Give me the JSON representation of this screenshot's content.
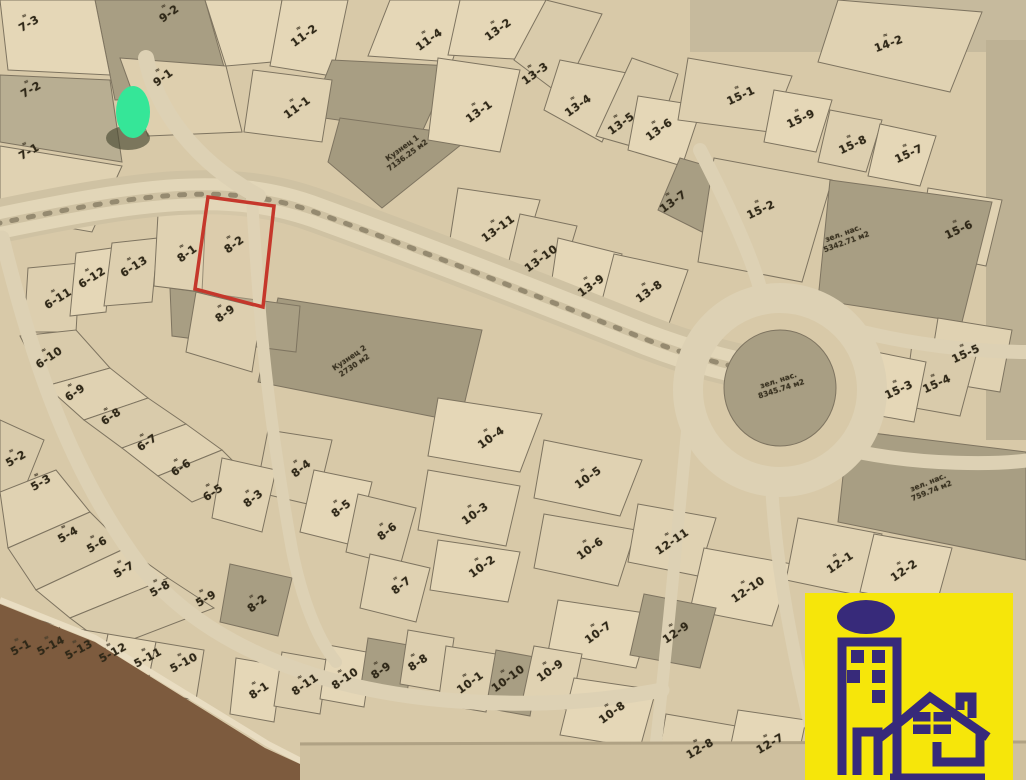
{
  "map": {
    "type": "cadastral-plot-plan-photo",
    "marker": {
      "name": "green-location-dot",
      "x": 133,
      "y": 113
    },
    "highlighted_plot": {
      "id": "8-2",
      "outline_color": "#c5372b"
    },
    "colors": {
      "paper": "#d8c9a8",
      "parcel_light": "#e5d7b7",
      "parcel_dark": "#a89e83",
      "road": "#dcd0b2",
      "line": "#7e7460",
      "red_outline": "#c5372b",
      "green_dot": "#35e698",
      "logo_bg": "#f6e60a",
      "logo_fg": "#372a7a",
      "table_corner": "#7d5b3e"
    },
    "plot_labels": [
      {
        "t": "7-3",
        "x": 28,
        "y": 22,
        "r": -30
      },
      {
        "t": "7-2",
        "x": 30,
        "y": 88,
        "r": -30
      },
      {
        "t": "7-1",
        "x": 28,
        "y": 150,
        "r": -30
      },
      {
        "t": "9-2",
        "x": 168,
        "y": 12,
        "r": -36
      },
      {
        "t": "9-1",
        "x": 162,
        "y": 76,
        "r": -36
      },
      {
        "t": "11-2",
        "x": 303,
        "y": 34,
        "r": -36
      },
      {
        "t": "11-4",
        "x": 428,
        "y": 38,
        "r": -36
      },
      {
        "t": "11-1",
        "x": 296,
        "y": 106,
        "r": -36
      },
      {
        "t": "13-2",
        "x": 497,
        "y": 28,
        "r": -36
      },
      {
        "t": "13-3",
        "x": 534,
        "y": 72,
        "r": -36
      },
      {
        "t": "13-1",
        "x": 478,
        "y": 110,
        "r": -36
      },
      {
        "t": "13-4",
        "x": 577,
        "y": 104,
        "r": -36
      },
      {
        "t": "13-5",
        "x": 620,
        "y": 122,
        "r": -36
      },
      {
        "t": "13-6",
        "x": 658,
        "y": 128,
        "r": -36
      },
      {
        "t": "13-7",
        "x": 672,
        "y": 200,
        "r": -36
      },
      {
        "t": "14-2",
        "x": 888,
        "y": 42,
        "r": -20
      },
      {
        "t": "15-1",
        "x": 740,
        "y": 94,
        "r": -25
      },
      {
        "t": "15-9",
        "x": 800,
        "y": 117,
        "r": -25
      },
      {
        "t": "15-8",
        "x": 852,
        "y": 143,
        "r": -25
      },
      {
        "t": "15-7",
        "x": 908,
        "y": 152,
        "r": -25
      },
      {
        "t": "15-2",
        "x": 760,
        "y": 208,
        "r": -25
      },
      {
        "t": "15-6",
        "x": 958,
        "y": 228,
        "r": -25
      },
      {
        "t": "15-5",
        "x": 965,
        "y": 352,
        "r": -25
      },
      {
        "t": "15-4",
        "x": 936,
        "y": 382,
        "r": -25
      },
      {
        "t": "15-3",
        "x": 898,
        "y": 388,
        "r": -25
      },
      {
        "t": "13-11",
        "x": 497,
        "y": 227,
        "r": -36
      },
      {
        "t": "13-10",
        "x": 540,
        "y": 257,
        "r": -36
      },
      {
        "t": "13-9",
        "x": 590,
        "y": 284,
        "r": -36
      },
      {
        "t": "13-8",
        "x": 648,
        "y": 290,
        "r": -36
      },
      {
        "t": "6-11",
        "x": 57,
        "y": 297,
        "r": -32
      },
      {
        "t": "6-12",
        "x": 91,
        "y": 276,
        "r": -32
      },
      {
        "t": "6-13",
        "x": 133,
        "y": 265,
        "r": -32
      },
      {
        "t": "8-1",
        "x": 186,
        "y": 252,
        "r": -36
      },
      {
        "t": "8-2",
        "x": 233,
        "y": 243,
        "r": -36
      },
      {
        "t": "8-9",
        "x": 224,
        "y": 312,
        "r": -36
      },
      {
        "t": "6-10",
        "x": 48,
        "y": 356,
        "r": -34
      },
      {
        "t": "6-9",
        "x": 74,
        "y": 391,
        "r": -34
      },
      {
        "t": "6-8",
        "x": 110,
        "y": 415,
        "r": -34
      },
      {
        "t": "6-7",
        "x": 146,
        "y": 441,
        "r": -34
      },
      {
        "t": "6-6",
        "x": 180,
        "y": 466,
        "r": -34
      },
      {
        "t": "6-5",
        "x": 212,
        "y": 491,
        "r": -34
      },
      {
        "t": "5-2",
        "x": 15,
        "y": 457,
        "r": -30
      },
      {
        "t": "5-3",
        "x": 40,
        "y": 481,
        "r": -30
      },
      {
        "t": "5-4",
        "x": 67,
        "y": 533,
        "r": -30
      },
      {
        "t": "5-6",
        "x": 96,
        "y": 543,
        "r": -30
      },
      {
        "t": "5-7",
        "x": 123,
        "y": 568,
        "r": -30
      },
      {
        "t": "5-8",
        "x": 159,
        "y": 587,
        "r": -30
      },
      {
        "t": "5-9",
        "x": 205,
        "y": 597,
        "r": -30
      },
      {
        "t": "5-1",
        "x": 20,
        "y": 646,
        "r": -28
      },
      {
        "t": "5-14",
        "x": 50,
        "y": 644,
        "r": -28
      },
      {
        "t": "5-13",
        "x": 78,
        "y": 648,
        "r": -28
      },
      {
        "t": "5-12",
        "x": 112,
        "y": 651,
        "r": -28
      },
      {
        "t": "5-11",
        "x": 147,
        "y": 656,
        "r": -28
      },
      {
        "t": "5-10",
        "x": 183,
        "y": 661,
        "r": -28
      },
      {
        "t": "8-3",
        "x": 252,
        "y": 497,
        "r": -38
      },
      {
        "t": "8-4",
        "x": 300,
        "y": 467,
        "r": -38
      },
      {
        "t": "8-5",
        "x": 340,
        "y": 507,
        "r": -38
      },
      {
        "t": "8-6",
        "x": 386,
        "y": 530,
        "r": -38
      },
      {
        "t": "8-7",
        "x": 400,
        "y": 584,
        "r": -38
      },
      {
        "t": "8-2",
        "x": 256,
        "y": 602,
        "r": -38
      },
      {
        "t": "8-1",
        "x": 258,
        "y": 689,
        "r": -34
      },
      {
        "t": "8-11",
        "x": 304,
        "y": 683,
        "r": -34
      },
      {
        "t": "8-10",
        "x": 344,
        "y": 677,
        "r": -34
      },
      {
        "t": "8-9",
        "x": 380,
        "y": 669,
        "r": -34
      },
      {
        "t": "8-8",
        "x": 417,
        "y": 661,
        "r": -34
      },
      {
        "t": "10-4",
        "x": 490,
        "y": 436,
        "r": -36
      },
      {
        "t": "10-3",
        "x": 474,
        "y": 512,
        "r": -36
      },
      {
        "t": "10-2",
        "x": 481,
        "y": 565,
        "r": -36
      },
      {
        "t": "10-5",
        "x": 587,
        "y": 476,
        "r": -36
      },
      {
        "t": "10-6",
        "x": 589,
        "y": 547,
        "r": -36
      },
      {
        "t": "10-7",
        "x": 597,
        "y": 631,
        "r": -36
      },
      {
        "t": "10-1",
        "x": 469,
        "y": 681,
        "r": -36
      },
      {
        "t": "10-10",
        "x": 507,
        "y": 677,
        "r": -36
      },
      {
        "t": "10-9",
        "x": 549,
        "y": 669,
        "r": -36
      },
      {
        "t": "10-8",
        "x": 611,
        "y": 711,
        "r": -36
      },
      {
        "t": "12-11",
        "x": 671,
        "y": 540,
        "r": -34
      },
      {
        "t": "12-10",
        "x": 747,
        "y": 588,
        "r": -34
      },
      {
        "t": "12-9",
        "x": 675,
        "y": 631,
        "r": -34
      },
      {
        "t": "12-1",
        "x": 839,
        "y": 561,
        "r": -34
      },
      {
        "t": "12-2",
        "x": 903,
        "y": 569,
        "r": -34
      },
      {
        "t": "12-8",
        "x": 699,
        "y": 747,
        "r": -30
      },
      {
        "t": "12-7",
        "x": 769,
        "y": 742,
        "r": -30
      }
    ],
    "area_labels": [
      {
        "lines": [
          "Кузнец 1",
          "7136.25 м2"
        ],
        "x": 405,
        "y": 152,
        "r": -36
      },
      {
        "lines": [
          "Кузнец 2",
          "2730 м2"
        ],
        "x": 352,
        "y": 362,
        "r": -34
      },
      {
        "lines": [
          "зел. нас.",
          "8345.74 м2"
        ],
        "x": 780,
        "y": 385,
        "r": -18
      },
      {
        "lines": [
          "зел. нас.",
          "5342.71 м2"
        ],
        "x": 845,
        "y": 238,
        "r": -20
      },
      {
        "lines": [
          "зел. нас.",
          "759.74 м2"
        ],
        "x": 930,
        "y": 487,
        "r": -22
      }
    ]
  },
  "logo": {
    "name": "realty-agency-logo",
    "icons": [
      "building-icon",
      "house-icon",
      "sun-ellipse-icon"
    ]
  }
}
